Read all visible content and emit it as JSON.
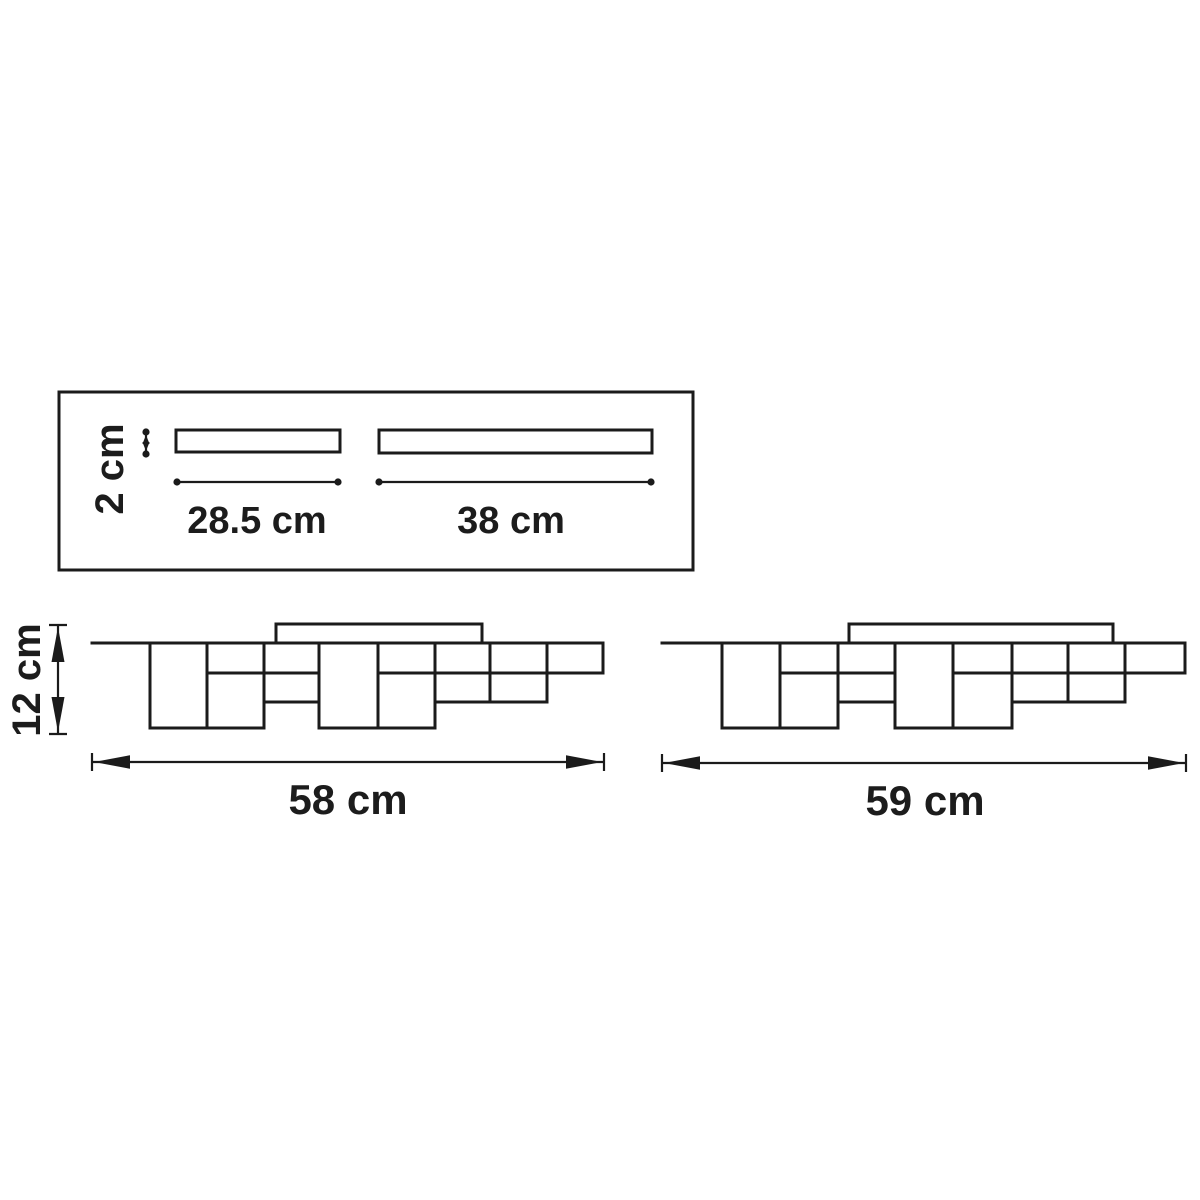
{
  "diagram": {
    "kind": "ceiling-lamp dimension drawing",
    "colors": {
      "line": "#1b1b1b",
      "background": "#ffffff"
    },
    "mount_panel": {
      "plate_height_label": "2 cm",
      "short_plate_length_label": "28.5 cm",
      "long_plate_length_label": "38 cm"
    },
    "fixture_left": {
      "height_label": "12 cm",
      "width_label": "58 cm"
    },
    "fixture_right": {
      "width_label": "59 cm"
    }
  }
}
